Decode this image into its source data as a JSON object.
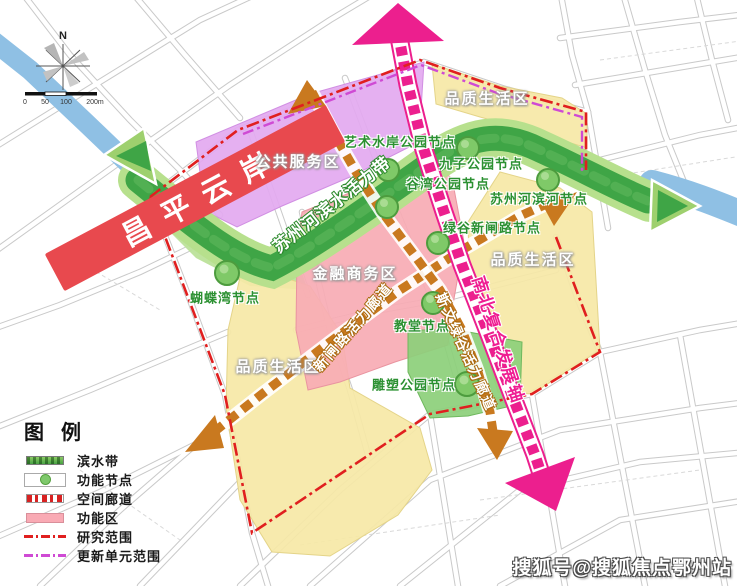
{
  "map": {
    "banner_label": "昌平云岸",
    "river_band_label": "苏州河滨水活力带",
    "axis_label": "南北复合发展轴",
    "corridor_labels": {
      "xinzha": "新闸路活力廊道",
      "siwen": "斯文绿谷活力廊道"
    },
    "zone_labels": {
      "public_service": "公共服务区",
      "finance_business": "金融商务区",
      "quality_life_top": "品质生活区",
      "quality_life_right": "品质生活区",
      "quality_life_bottom": "品质生活区"
    },
    "node_labels": {
      "art_waterfront": "艺术水岸公园节点",
      "jiuzi_park": "九子公园节点",
      "guwan_park": "谷湾公园节点",
      "suzhou_riverside": "苏州河滨河节点",
      "lvgu_xinzha": "绿谷新闸路节点",
      "butterfly_bay": "蝴蝶湾节点",
      "church": "教堂节点",
      "sculpture_park": "雕塑公园节点"
    },
    "compass_north": "N",
    "scale_ticks": [
      "0",
      "50",
      "100",
      "200m"
    ]
  },
  "legend": {
    "title": "图 例",
    "items": [
      {
        "label": "滨水带"
      },
      {
        "label": "功能节点"
      },
      {
        "label": "空间廊道"
      },
      {
        "label": "功能区"
      },
      {
        "label": "研究范围"
      },
      {
        "label": "更新单元范围"
      }
    ]
  },
  "watermark": "搜狐号@搜狐焦点鄂州站",
  "colors": {
    "river_band_green": "#3fa546",
    "band_edge_green": "#b7e08d",
    "axis_magenta": "#ec1f8e",
    "corridor_brown": "#c9791f",
    "zone_purple": "#e3a9f0",
    "zone_pink": "#f7abb4",
    "zone_yellow": "#f6e8a6",
    "zone_green": "#8ccf7a",
    "node_green": "#7fc968",
    "river_blue": "#8fc0e4",
    "banner_red": "#e8494e",
    "research_boundary_red": "#e01f1f",
    "renewal_boundary_violet": "#cf4ad4"
  }
}
